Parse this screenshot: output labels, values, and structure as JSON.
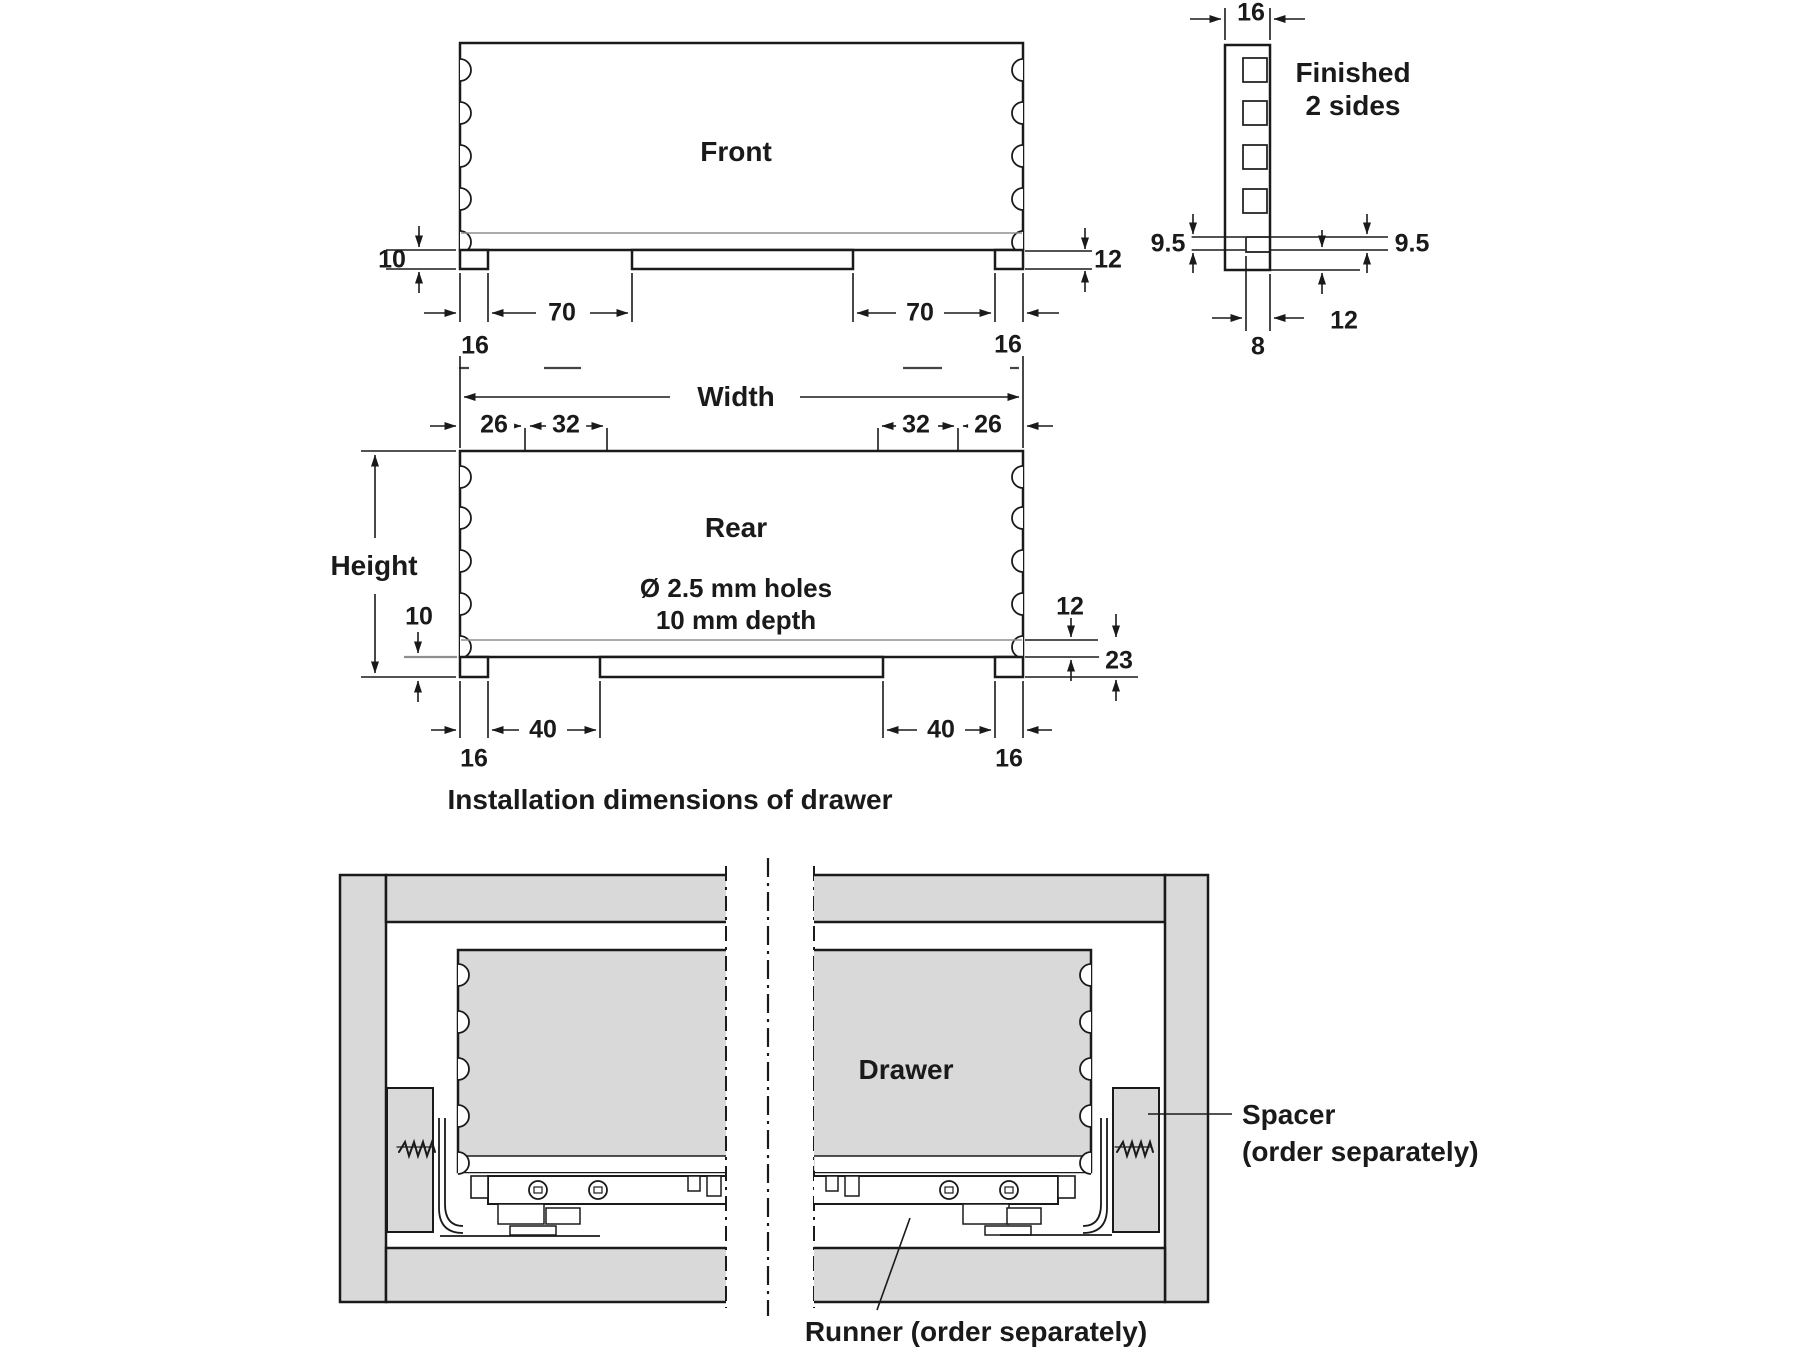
{
  "views": {
    "front": {
      "label": "Front",
      "dim_groove_to_bottom": "10",
      "dim_bottom_rail": "12",
      "dim_recess_left": "70",
      "dim_recess_right": "70",
      "dim_foot_left": "16",
      "dim_foot_right": "16"
    },
    "side": {
      "dim_thickness": "16",
      "finish_note_line1": "Finished",
      "finish_note_line2": "2 sides",
      "dim_groove_left": "9.5",
      "dim_groove_right": "9.5",
      "dim_groove_width": "8",
      "dim_bottom": "12"
    },
    "rear": {
      "label": "Rear",
      "holes_note_line1": "Ø 2.5 mm holes",
      "holes_note_line2": "10 mm depth",
      "dim_width": "Width",
      "dim_height": "Height",
      "dim_edge_left": "26",
      "dim_pitch_left": "32",
      "dim_pitch_right": "32",
      "dim_edge_right": "26",
      "dim_groove_to_bottom": "10",
      "dim_bottom_rail": "12",
      "dim_foot_height": "23",
      "dim_recess_left": "40",
      "dim_recess_right": "40",
      "dim_foot_left": "16",
      "dim_foot_right": "16"
    }
  },
  "caption": "Installation dimensions of drawer",
  "installation": {
    "drawer_label": "Drawer",
    "spacer_label_line1": "Spacer",
    "spacer_label_line2": "(order separately)",
    "runner_label": "Runner (order separately)"
  },
  "colors": {
    "line": "#1a1a1a",
    "panel_fill": "#d9d9d9",
    "groove_line": "#8f8f8f"
  }
}
